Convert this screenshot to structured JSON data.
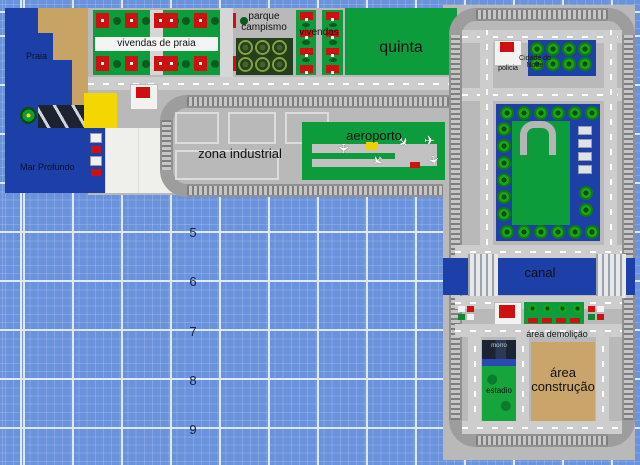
{
  "labels": {
    "praia": "Praia",
    "mar_profundo": "Mar Profundo",
    "vivendas_de_praia": "vivendas de praia",
    "parque_l1": "parque",
    "parque_l2": "campismo",
    "vivendas": "vivendas",
    "quinta": "quinta",
    "zona_industrial": "zona industrial",
    "aeroporto": "aeroporto",
    "policia": "policia",
    "cidade_l1": "Cidade do",
    "cidade_l2": "Norte",
    "canal": "canal",
    "area_demolicao": "área demolição",
    "construcao_l1": "área",
    "construcao_l2": "construção",
    "estadio": "estadio",
    "morro": "morro"
  },
  "row_numbers": [
    "5",
    "6",
    "7",
    "8",
    "9"
  ],
  "colors": {
    "water_grid": "#6b92dc",
    "grid_major_line": "#dfe8f7",
    "deep_sea": "#1d3fa8",
    "sand": "#c7a366",
    "construction_tan": "#c9a56b",
    "plate_gray": "#b9b9b9",
    "road_gray": "#cdcdcd",
    "grass_green": "#0c9c3c",
    "house_red": "#cf1010",
    "beach_yellow": "#f2d800",
    "canal_blue": "#1d3fa8"
  },
  "decor": {
    "groups": [
      {
        "container": "beach-row-1a",
        "classes": [
          "house",
          "bush"
        ],
        "count": 6
      },
      {
        "container": "beach-row-1b",
        "classes": [
          "house",
          "bush"
        ],
        "count": 6
      },
      {
        "container": "beach-row-2a",
        "classes": [
          "house",
          "bush"
        ],
        "count": 6
      },
      {
        "container": "beach-row-2b",
        "classes": [
          "house",
          "bush"
        ],
        "count": 6
      },
      {
        "container": "vivendas-col-1",
        "classes": [
          "house",
          "bush"
        ],
        "count": 7
      },
      {
        "container": "vivendas-col-2",
        "classes": [
          "house",
          "bush"
        ],
        "count": 7
      },
      {
        "container": "campsite-rings",
        "classes": [
          "ring"
        ],
        "count": 6
      },
      {
        "container": "plaza-trees",
        "classes": [
          "tree"
        ],
        "count": 8
      },
      {
        "container": "park-trees-top",
        "classes": [
          "tree"
        ],
        "count": 6
      },
      {
        "container": "park-trees-bottom",
        "classes": [
          "tree"
        ],
        "count": 6
      },
      {
        "container": "park-trees-left",
        "classes": [
          "tree"
        ],
        "count": 6
      },
      {
        "container": "park-trees-right",
        "classes": [
          "tree"
        ],
        "count": 2
      },
      {
        "container": "park-structures",
        "classes": [
          "shed"
        ],
        "count": 4
      },
      {
        "container": "dock-boats",
        "classes": [
          "boat-a",
          "boat-b"
        ],
        "count": 4
      },
      {
        "container": "stalls-left",
        "classes": [
          "stall-a",
          "stall-b",
          "stall-c"
        ],
        "count": 4
      },
      {
        "container": "stalls-right",
        "classes": [
          "stall-b",
          "stall-a",
          "stall-c"
        ],
        "count": 4
      },
      {
        "container": "demolition-trees",
        "classes": [
          "tree-sm"
        ],
        "count": 4
      },
      {
        "container": "parking-cars",
        "classes": [
          "car"
        ],
        "count": 4
      }
    ],
    "planes": [
      {
        "x": 36,
        "y": 20,
        "r": 90
      },
      {
        "x": 96,
        "y": 14,
        "r": 45
      },
      {
        "x": 122,
        "y": 12,
        "r": 0
      },
      {
        "x": 70,
        "y": 32,
        "r": 135
      },
      {
        "x": 126,
        "y": 32,
        "r": 80
      }
    ]
  }
}
